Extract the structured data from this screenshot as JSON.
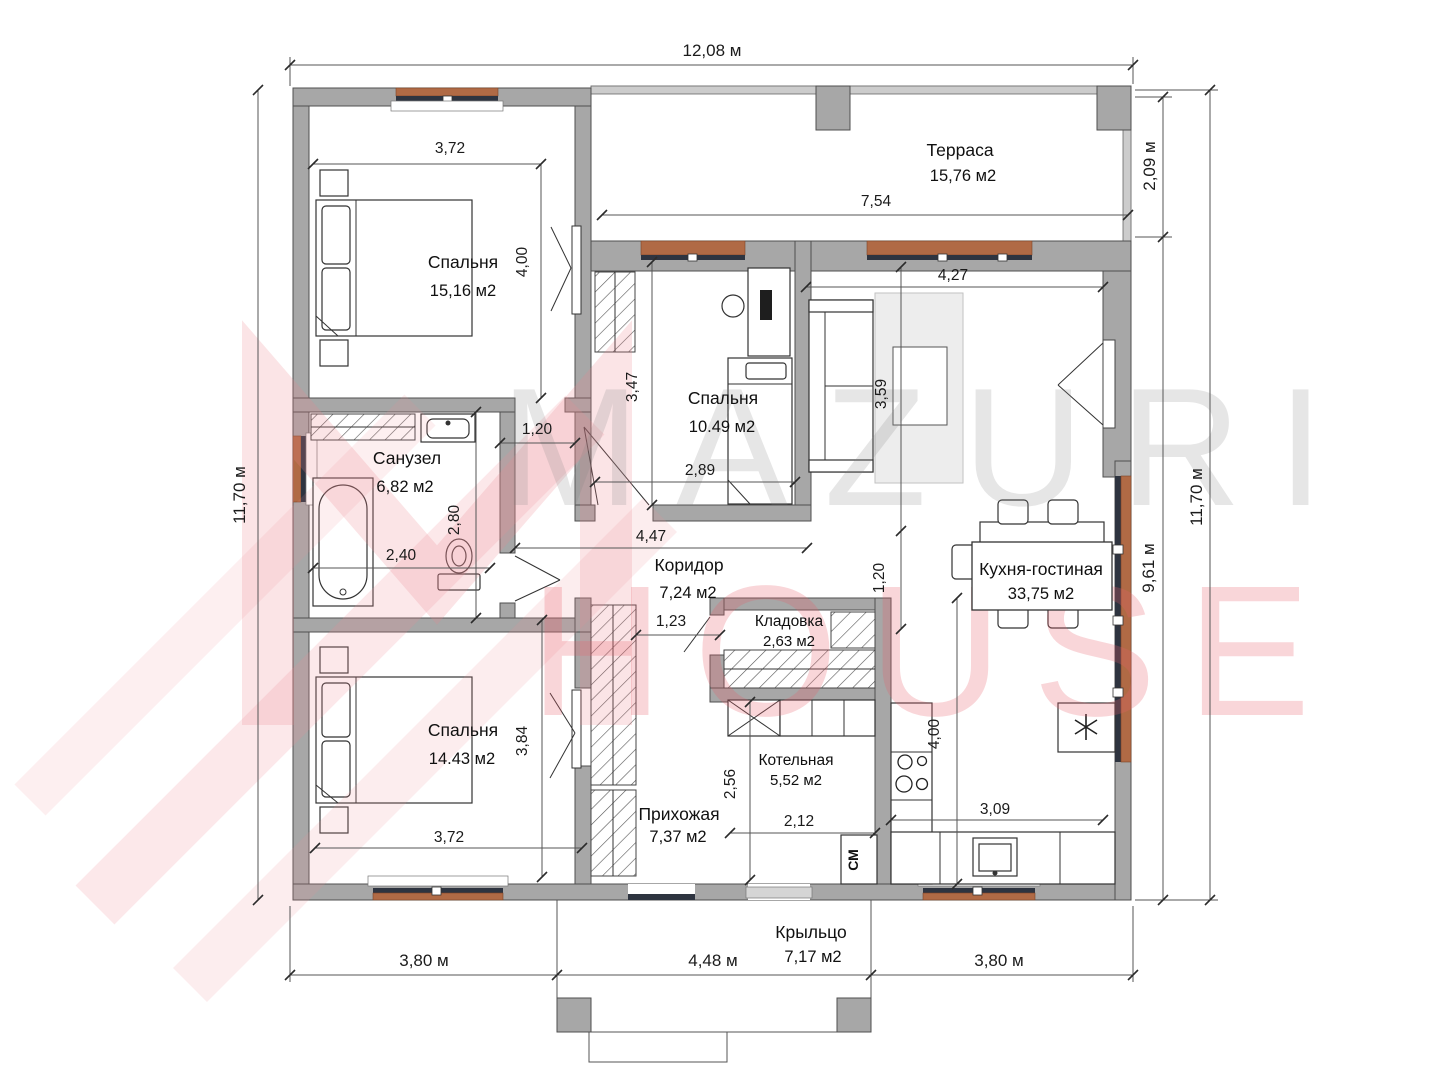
{
  "watermark": {
    "line1": "MAZURI",
    "line2": "HOUSE"
  },
  "dimensions": {
    "top": "12,08 м",
    "left": "11,70 м",
    "right_total": "11,70 м",
    "right_terrace": "2,09 м",
    "right_lower": "9,61 м",
    "bottom_left": "3,80 м",
    "bottom_center": "4,48 м",
    "bottom_right": "3,80 м"
  },
  "rooms": {
    "bedroom1": {
      "name": "Спальня",
      "area": "15,16 м2"
    },
    "terrace": {
      "name": "Терраса",
      "area": "15,76 м2"
    },
    "bedroom2": {
      "name": "Спальня",
      "area": "10.49 м2"
    },
    "kitchen_living": {
      "name": "Кухня-гостиная",
      "area": "33,75 м2"
    },
    "bathroom": {
      "name": "Санузел",
      "area": "6,82 м2"
    },
    "corridor": {
      "name": "Коридор",
      "area": "7,24 м2"
    },
    "pantry": {
      "name": "Кладовка",
      "area": "2,63 м2"
    },
    "bedroom3": {
      "name": "Спальня",
      "area": "14.43 м2"
    },
    "hallway": {
      "name": "Прихожая",
      "area": "7,37 м2"
    },
    "boiler": {
      "name": "Котельная",
      "area": "5,52 м2"
    },
    "porch": {
      "name": "Крыльцо",
      "area": "7,17 м2"
    }
  },
  "interior_dimensions": {
    "bedroom1_width": "3,72",
    "bedroom1_height": "4,00",
    "terrace_width": "7,54",
    "kitchen_top_width": "4,27",
    "bedroom2_height": "3,47",
    "bedroom2_width": "2,89",
    "kitchen_upper_height": "3,59",
    "nook_width": "1,20",
    "bathroom_height": "2,80",
    "bathroom_width": "2,40",
    "corridor_length": "4,47",
    "kitchen_mid_height": "1,20",
    "corridor_width": "1,23",
    "bedroom3_height": "3,84",
    "bedroom3_width": "3,72",
    "boiler_height": "2,56",
    "boiler_width": "2,12",
    "kitchen_counter_width": "3,09",
    "kitchen_lower_height": "4,00"
  },
  "labels": {
    "washing_machine": "СМ"
  },
  "icons": {
    "fridge": "snowflake-asterisk-icon"
  },
  "colors": {
    "wall": "#a7a7a7",
    "wall_outline": "#4f4f4f",
    "window_sill": "#b06a45",
    "window_frame": "#2e3440",
    "watermark_pink": "#e9626c",
    "watermark_gray": "#828282"
  }
}
